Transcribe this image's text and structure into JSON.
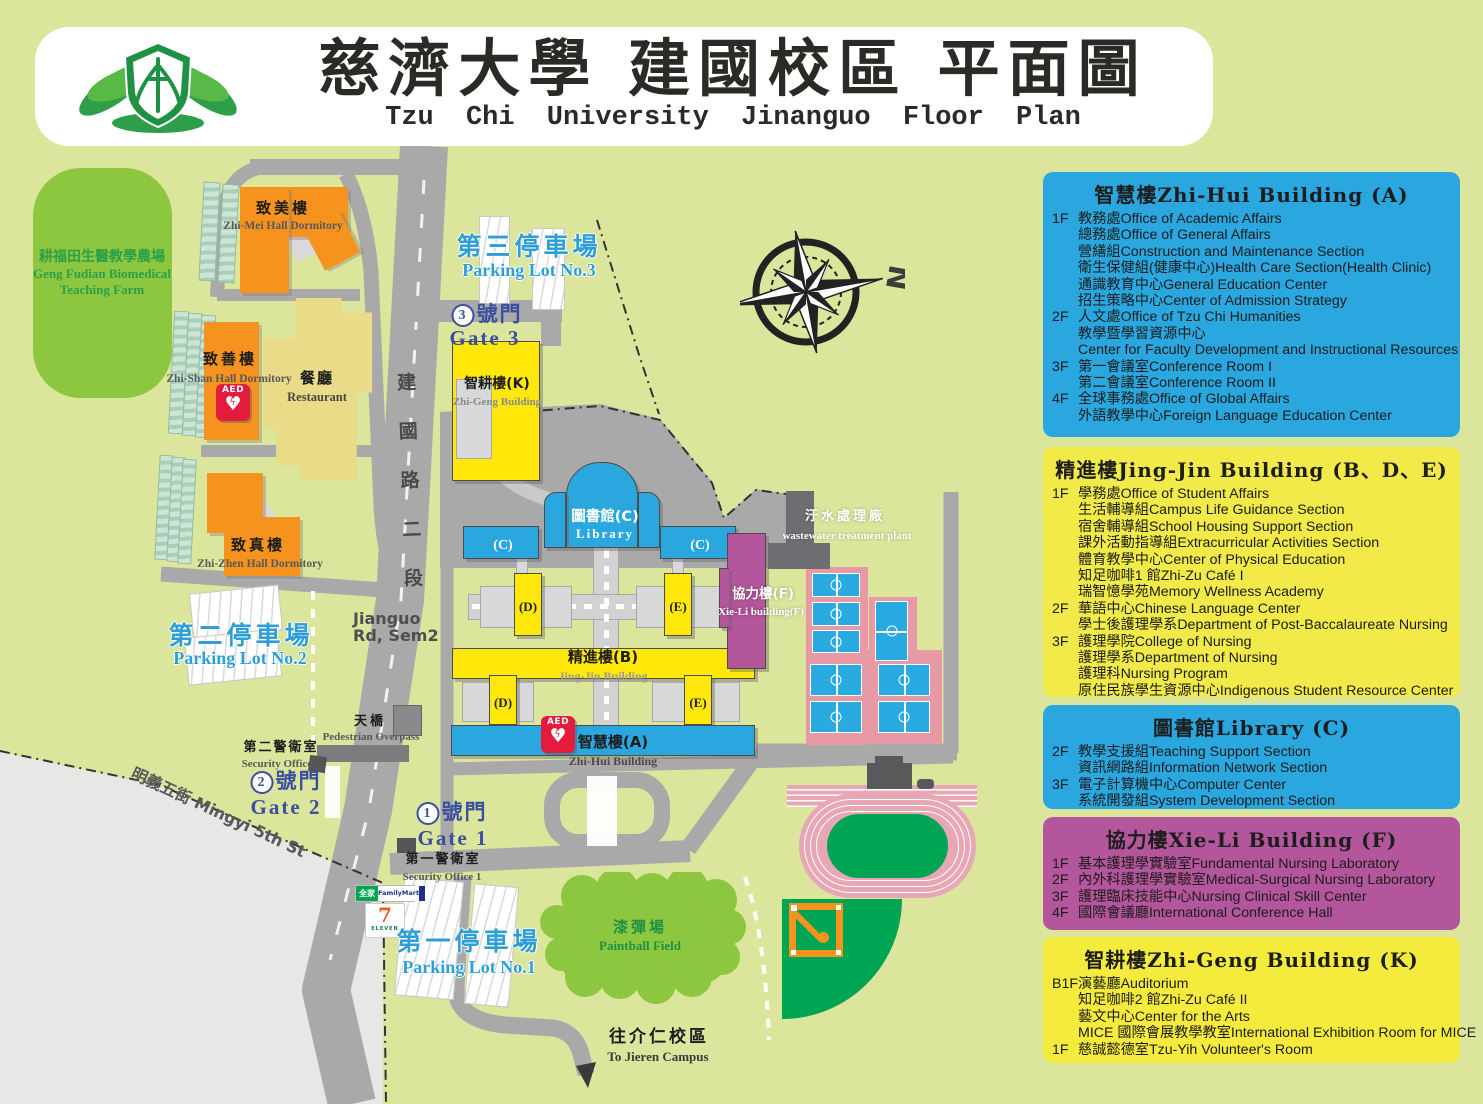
{
  "header": {
    "title_zh": "慈濟大學 建國校區 平面圖",
    "title_en": "Tzu Chi University  Jinanguo  Floor Plan",
    "logo": "tzu-chi-lotus-emblem"
  },
  "compass": {
    "north_label": "N"
  },
  "legend": {
    "panels": [
      {
        "id": "zhihui",
        "color": "#2AA7DF",
        "title": "智慧樓Zhi-Hui Building (A)",
        "items": [
          {
            "floor": "1F",
            "text": "教務處Office of Academic Affairs"
          },
          {
            "floor": "",
            "text": "總務處Office of General Affairs"
          },
          {
            "floor": "",
            "text": "營繕組Construction and Maintenance Section"
          },
          {
            "floor": "",
            "text": "衛生保健組(健康中心)Health Care Section(Health Clinic)"
          },
          {
            "floor": "",
            "text": "通識教育中心General Education Center"
          },
          {
            "floor": "",
            "text": "招生策略中心Center of Admission Strategy"
          },
          {
            "floor": "2F",
            "text": "人文處Office of Tzu Chi Humanities"
          },
          {
            "floor": "",
            "text": "教學暨學習資源中心"
          },
          {
            "floor": "",
            "text": "Center for Faculty Development and Instructional Resources"
          },
          {
            "floor": "3F",
            "text": "第一會議室Conference Room I"
          },
          {
            "floor": "",
            "text": "第二會議室Conference Room II"
          },
          {
            "floor": "4F",
            "text": "全球事務處Office of Global Affairs"
          },
          {
            "floor": "",
            "text": "外語教學中心Foreign Language Education Center"
          }
        ]
      },
      {
        "id": "jingjin",
        "color": "#F1EA48",
        "title": "精進樓Jing-Jin Building (B、D、E)",
        "items": [
          {
            "floor": "1F",
            "text": "學務處Office of Student Affairs"
          },
          {
            "floor": "",
            "text": "生活輔導組Campus Life Guidance Section"
          },
          {
            "floor": "",
            "text": "宿舍輔導組School Housing Support Section"
          },
          {
            "floor": "",
            "text": "課外活動指導組Extracurricular Activities Section"
          },
          {
            "floor": "",
            "text": "體育教學中心Center of Physical Education"
          },
          {
            "floor": "",
            "text": "知足咖啡1 館Zhi-Zu Café I"
          },
          {
            "floor": "",
            "text": "瑞智憶學苑Memory Wellness Academy"
          },
          {
            "floor": "2F",
            "text": "華語中心Chinese Language Center"
          },
          {
            "floor": "",
            "text": "學士後護理學系Department of Post-Baccalaureate Nursing"
          },
          {
            "floor": "3F",
            "text": "護理學院College of Nursing"
          },
          {
            "floor": "",
            "text": "護理學系Department of Nursing"
          },
          {
            "floor": "",
            "text": "護理科Nursing Program"
          },
          {
            "floor": "",
            "text": "原住民族學生資源中心Indigenous Student Resource Center"
          }
        ]
      },
      {
        "id": "library",
        "color": "#2AA7DF",
        "title": "圖書館Library (C)",
        "items": [
          {
            "floor": "2F",
            "text": "教學支援組Teaching Support Section"
          },
          {
            "floor": "",
            "text": "資訊網路組Information Network Section"
          },
          {
            "floor": "3F",
            "text": "電子計算機中心Computer Center"
          },
          {
            "floor": "",
            "text": "系統開發組System Development Section"
          }
        ]
      },
      {
        "id": "xieli",
        "color": "#B3569B",
        "title": "協力樓Xie-Li Building (F)",
        "items": [
          {
            "floor": "1F",
            "text": "基本護理學實驗室Fundamental Nursing Laboratory"
          },
          {
            "floor": "2F",
            "text": "內外科護理學實驗室Medical-Surgical Nursing Laboratory"
          },
          {
            "floor": "3F",
            "text": "護理臨床技能中心Nursing Clinical Skill Center"
          },
          {
            "floor": "4F",
            "text": "國際會議廳International Conference Hall"
          }
        ]
      },
      {
        "id": "zhigeng",
        "color": "#F5EB3C",
        "title": "智耕樓Zhi-Geng Building (K)",
        "items": [
          {
            "floor": "B1F",
            "text": "演藝廳Auditorium"
          },
          {
            "floor": "",
            "text": "知足咖啡2 館Zhi-Zu Café II"
          },
          {
            "floor": "",
            "text": "藝文中心Center for the Arts"
          },
          {
            "floor": "",
            "text": "MICE 國際會展教學教室International Exhibition Room for MICE"
          },
          {
            "floor": "1F",
            "text": "慈誠懿德室Tzu-Yih Volunteer's Room"
          }
        ]
      }
    ]
  },
  "map": {
    "labels": {
      "farm_zh": "耕福田生醫教學農場",
      "farm_en1": "Geng Fudian Biomedical",
      "farm_en2": "Teaching Farm",
      "zhimei_zh": "致美樓",
      "zhimei_en": "Zhi-Mei Hall Dormitory",
      "zhishan_zh": "致善樓",
      "zhishan_en": "Zhi-Shan Hall Dormitory",
      "zhizhen_zh": "致真樓",
      "zhizhen_en": "Zhi-Zhen Hall Dormitory",
      "restaurant_zh": "餐廳",
      "restaurant_en": "Restaurant",
      "zhigeng_zh": "智耕樓(K)",
      "zhigeng_en": "Zhi-Geng Building",
      "library_zh": "圖書館(C)",
      "library_en": "Library",
      "jingjin_zh": "精進樓(B)",
      "jingjin_en": "Jing-Jin Building",
      "zhihui_zh": "智慧樓(A)",
      "zhihui_en": "Zhi-Hui Building",
      "xieli_zh": "協力樓(F)",
      "xieli_en": "Xie-Li building(F)",
      "wastewater_zh": "汙水處理廠",
      "wastewater_en": "wastewater treatment plant",
      "overpass_zh": "天橋",
      "overpass_en": "Pedestrian Overpass",
      "sec2_zh": "第二警衛室",
      "sec2_en": "Security Office 2",
      "sec1_zh": "第一警衛室",
      "sec1_en": "Security Office 1",
      "p3_zh": "第三停車場",
      "p3_en": "Parking Lot No.3",
      "p2_zh": "第二停車場",
      "p2_en": "Parking Lot No.2",
      "p1_zh": "第一停車場",
      "p1_en": "Parking Lot No.1",
      "g3_num": "3",
      "g3_zh": "號門",
      "g3_en": "Gate 3",
      "g2_num": "2",
      "g2_zh": "號門",
      "g2_en": "Gate 2",
      "g1_num": "1",
      "g1_zh": "號門",
      "g1_en": "Gate 1",
      "paintball_zh": "漆彈場",
      "paintball_en": "Paintball Field",
      "jieren_zh": "往介仁校區",
      "jieren_en": "To Jieren Campus",
      "road_jianguo_v": "建國路二段",
      "road_jianguo_l1": "Jianguo",
      "road_jianguo_l2": "Rd, Sem2",
      "road_mingyi": "明義五街 Mingyi 5th St"
    },
    "wings": [
      "(C)",
      "(C)",
      "(D)",
      "(E)",
      "(D)",
      "(E)"
    ],
    "aed": "AED",
    "stores": {
      "familymart_zh": "全家",
      "familymart_en": "FamilyMart",
      "seven": "7",
      "seven_sub": "ELEVEN"
    }
  }
}
